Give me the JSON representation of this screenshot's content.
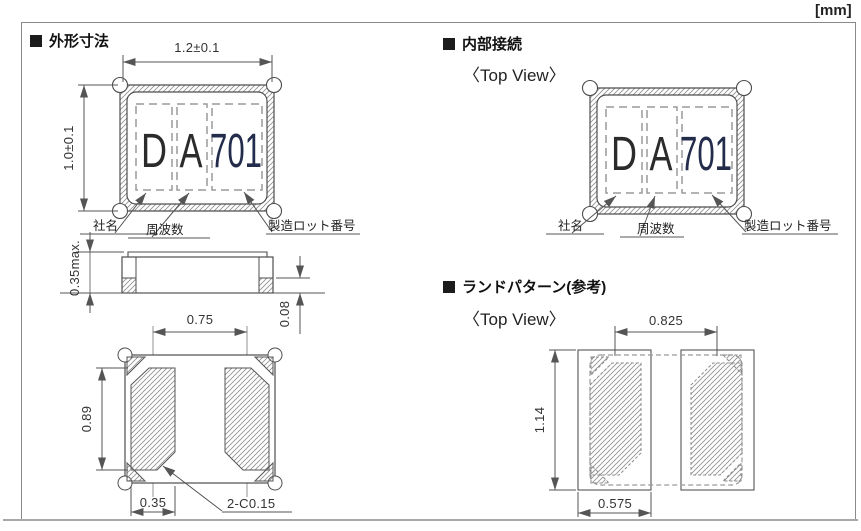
{
  "unit_label": "[mm]",
  "sections": {
    "outline": {
      "title": "外形寸法"
    },
    "internal": {
      "title": "内部接続",
      "view_label": "〈Top View〉"
    },
    "land": {
      "title": "ランドパターン(参考)",
      "view_label": "〈Top View〉"
    }
  },
  "marking": {
    "company_mark": "D",
    "frequency_mark": "A",
    "lot_mark": "701"
  },
  "field_labels": {
    "company": "社名",
    "frequency": "周波数",
    "lot": "製造ロット番号"
  },
  "dimensions": {
    "body_width": "1.2±0.1",
    "body_height": "1.0±0.1",
    "body_thickness": "0.35max.",
    "pad_thickness": "0.08",
    "pad_pitch": "0.75",
    "pad_length": "0.89",
    "pad_width": "0.35",
    "chamfer": "2-C0.15",
    "land_pitch": "0.825",
    "land_length": "1.14",
    "land_width": "0.575"
  },
  "colors": {
    "line": "#4d4d4d",
    "dim_line": "#555555",
    "hatch": "#949494",
    "marking_text": "#2b2b2b",
    "lot_text": "#242c4c"
  }
}
